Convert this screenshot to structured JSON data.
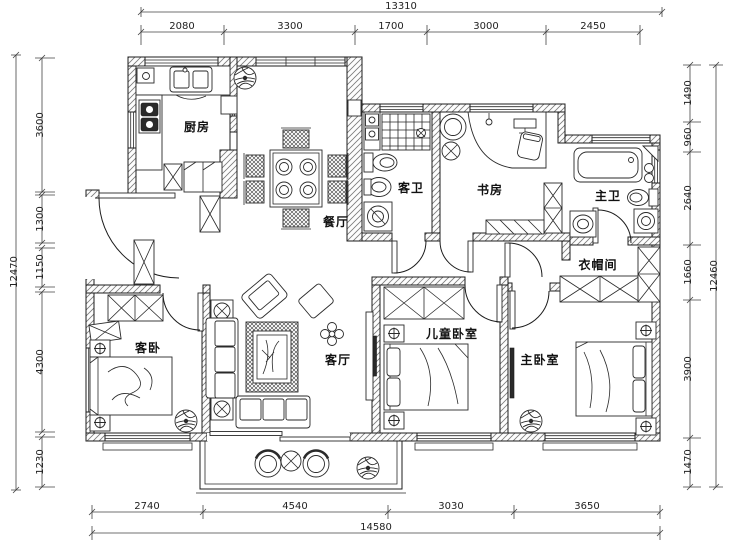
{
  "rooms": {
    "kitchen": "厨房",
    "dining": "餐厅",
    "guest_bath": "客卫",
    "study": "书房",
    "master_bath": "主卫",
    "closet": "衣帽间",
    "guest_bedroom": "客卧",
    "living": "客厅",
    "kids_bedroom": "儿童卧室",
    "master_bedroom": "主卧室"
  },
  "dims": {
    "top": {
      "total": "13310",
      "segments": [
        "2080",
        "3300",
        "1700",
        "3000",
        "2450"
      ]
    },
    "bottom": {
      "total": "14580",
      "segments": [
        "2740",
        "4540",
        "3030",
        "3650"
      ]
    },
    "left": {
      "total": "12470",
      "segments": [
        "3600",
        "1300",
        "1150",
        "4300",
        "1230"
      ]
    },
    "right": {
      "total": "12460",
      "segments": [
        "1490",
        "960",
        "2640",
        "1660",
        "3900",
        "1470"
      ]
    }
  },
  "colors": {
    "line": "#1c1c1c",
    "background": "#ffffff"
  }
}
